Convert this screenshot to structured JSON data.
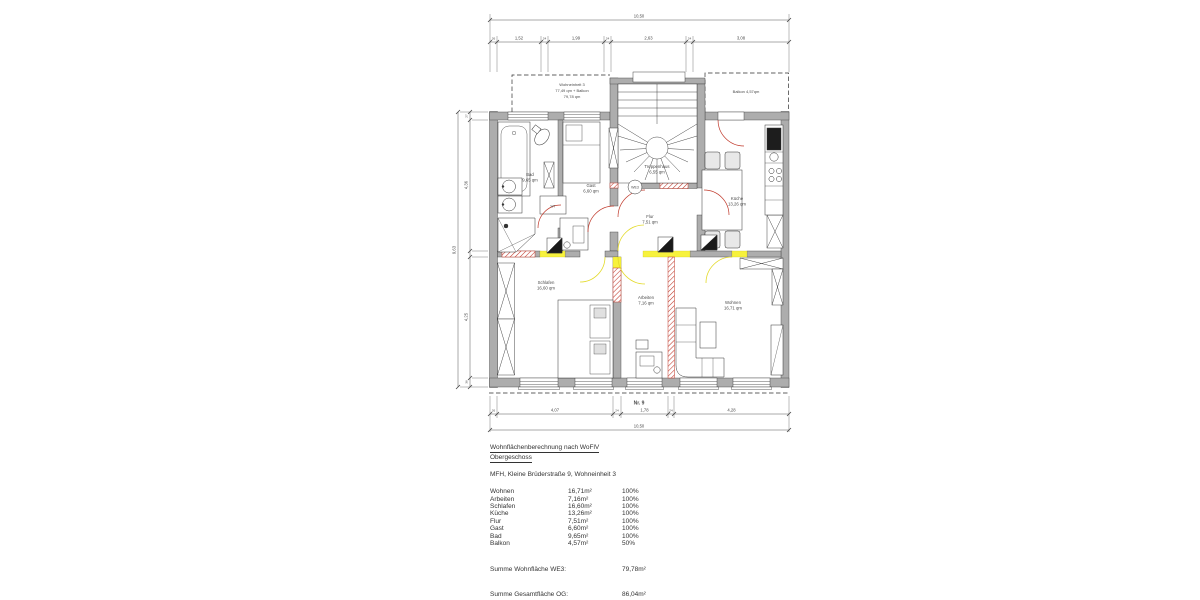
{
  "colors": {
    "wall_gray": "#adadad",
    "line": "#333333",
    "new_wall_red": "#c0392b",
    "demolition_yellow": "#f7f23c",
    "text": "#3a3a3a"
  },
  "plan": {
    "unit_box": {
      "line1": "Wohneinheit 3",
      "line2": "77,49 qm + Balkon",
      "line3": "79,78 qm"
    },
    "balcony_label": "Balkon 4,57qm",
    "we_badge": "WE3",
    "house_number": "Nr. 9",
    "fixture_labels": {
      "wt": "WT"
    },
    "rooms": [
      {
        "name": "Bad",
        "area": "9,65 qm"
      },
      {
        "name": "Gast",
        "area": "6,60 qm"
      },
      {
        "name": "Treppenhaus",
        "area": "6,55 qm"
      },
      {
        "name": "Flur",
        "area": "7,51 qm"
      },
      {
        "name": "Küche",
        "area": "13,26 qm"
      },
      {
        "name": "Schlafen",
        "area": "16,60 qm"
      },
      {
        "name": "Arbeiten",
        "area": "7,16 qm"
      },
      {
        "name": "Wohnen",
        "area": "16,71 qm"
      }
    ],
    "dimensions": {
      "top_total": "10,50",
      "top_segments": [
        "26",
        "1,52",
        "24",
        "1,99",
        "24",
        "2,63",
        "24",
        "3,08"
      ],
      "bottom_segments": [
        "26",
        "4,07",
        "24",
        "1,78",
        "24",
        "4,28"
      ],
      "bottom_total": "10,50",
      "left_total": "9,63",
      "left_segments": [
        "27",
        "4,36",
        "4,25",
        "36"
      ]
    }
  },
  "table": {
    "title": "Wohnflächenberechnung nach WoFlV",
    "subtitle": "Obergeschoss",
    "address": "MFH, Kleine Brüderstraße 9, Wohneinheit 3",
    "rows": [
      {
        "room": "Wohnen",
        "area": "16,71m²",
        "pct": "100%"
      },
      {
        "room": "Arbeiten",
        "area": "7,16m²",
        "pct": "100%"
      },
      {
        "room": "Schlafen",
        "area": "16,60m²",
        "pct": "100%"
      },
      {
        "room": "Küche",
        "area": "13,26m²",
        "pct": "100%"
      },
      {
        "room": "Flur",
        "area": "7,51m²",
        "pct": "100%"
      },
      {
        "room": "Gast",
        "area": "6,60m²",
        "pct": "100%"
      },
      {
        "room": "Bad",
        "area": "9,65m²",
        "pct": "100%"
      },
      {
        "room": "Balkon",
        "area": "4,57m²",
        "pct": "50%"
      }
    ],
    "sum_we": {
      "label": "Summe Wohnfläche WE3:",
      "value": "79,78m²"
    },
    "sum_og": {
      "label": "Summe Gesamtfläche OG:",
      "value": "86,04m²"
    }
  }
}
